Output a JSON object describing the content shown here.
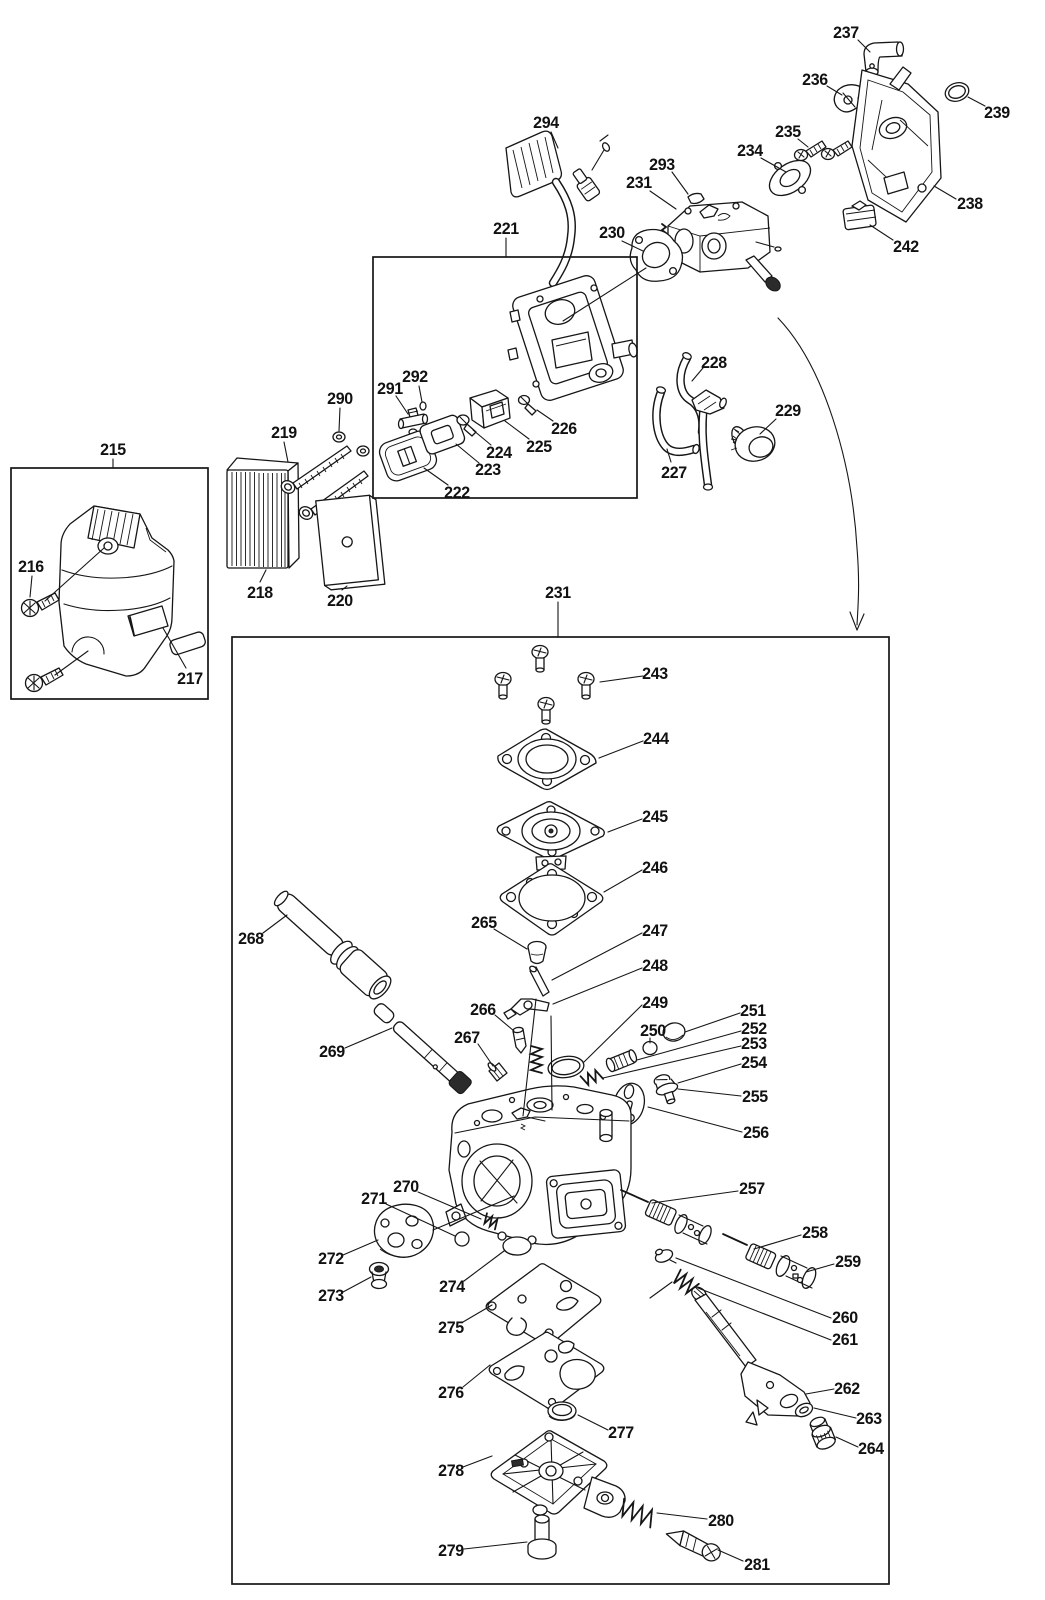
{
  "figure": {
    "background": "#ffffff",
    "ink": "#161616",
    "boxes": [
      {
        "x": 11,
        "y": 468,
        "w": 197,
        "h": 231
      },
      {
        "x": 373,
        "y": 257,
        "w": 264,
        "h": 241
      },
      {
        "x": 232,
        "y": 637,
        "w": 657,
        "h": 947
      }
    ],
    "arrow": {
      "path": "M778,318 C824,366 852,462 857,548 C860,585 858,606 857,625",
      "head": [
        [
          850,
          612,
          857,
          630
        ],
        [
          864,
          614,
          857,
          630
        ]
      ]
    },
    "extra_lines": [
      [
        45,
        601,
        104,
        548
      ],
      [
        55,
        675,
        88,
        651
      ],
      [
        646,
        268,
        563,
        321
      ],
      [
        536,
        999,
        523,
        1116
      ],
      [
        551,
        1016,
        552,
        1110
      ],
      [
        433,
        1230,
        514,
        1196
      ]
    ],
    "labels": [
      {
        "t": "215",
        "x": 113,
        "y": 449,
        "l": [
          113,
          459,
          113,
          468
        ]
      },
      {
        "t": "216",
        "x": 31,
        "y": 566,
        "l": [
          32,
          576,
          30,
          597
        ]
      },
      {
        "t": "217",
        "x": 190,
        "y": 678,
        "l": [
          186,
          668,
          163,
          628
        ]
      },
      {
        "t": "218",
        "x": 260,
        "y": 592,
        "l": [
          260,
          582,
          266,
          570
        ]
      },
      {
        "t": "219",
        "x": 284,
        "y": 432,
        "l": [
          284,
          442,
          288,
          462
        ]
      },
      {
        "t": "220",
        "x": 340,
        "y": 600,
        "l": [
          342,
          590,
          347,
          586
        ]
      },
      {
        "t": "221",
        "x": 506,
        "y": 228,
        "l": [
          506,
          238,
          506,
          257
        ]
      },
      {
        "t": "222",
        "x": 457,
        "y": 492,
        "l": [
          448,
          485,
          424,
          468
        ]
      },
      {
        "t": "223",
        "x": 488,
        "y": 469,
        "l": [
          479,
          463,
          456,
          444
        ]
      },
      {
        "t": "224",
        "x": 499,
        "y": 452,
        "l": [
          491,
          445,
          473,
          430
        ]
      },
      {
        "t": "225",
        "x": 539,
        "y": 446,
        "l": [
          529,
          439,
          505,
          421
        ]
      },
      {
        "t": "226",
        "x": 564,
        "y": 428,
        "l": [
          553,
          421,
          537,
          410
        ]
      },
      {
        "t": "227",
        "x": 674,
        "y": 472,
        "l": [
          671,
          462,
          667,
          449
        ]
      },
      {
        "t": "228",
        "x": 714,
        "y": 362,
        "l": [
          703,
          368,
          692,
          381
        ]
      },
      {
        "t": "229",
        "x": 788,
        "y": 410,
        "l": [
          776,
          419,
          760,
          434
        ]
      },
      {
        "t": "230",
        "x": 612,
        "y": 232,
        "l": [
          622,
          241,
          643,
          251
        ]
      },
      {
        "t": "231",
        "x": 639,
        "y": 182,
        "l": [
          650,
          191,
          676,
          209
        ]
      },
      {
        "t": "234",
        "x": 750,
        "y": 150,
        "l": [
          761,
          158,
          786,
          172
        ]
      },
      {
        "t": "235",
        "x": 788,
        "y": 131,
        "l": [
          798,
          139,
          808,
          147
        ]
      },
      {
        "t": "236",
        "x": 815,
        "y": 79,
        "l": [
          827,
          86,
          842,
          95
        ]
      },
      {
        "t": "237",
        "x": 846,
        "y": 32,
        "l": [
          858,
          40,
          870,
          52
        ]
      },
      {
        "t": "238",
        "x": 970,
        "y": 203,
        "l": [
          956,
          199,
          934,
          186
        ]
      },
      {
        "t": "239",
        "x": 997,
        "y": 112,
        "l": [
          985,
          106,
          968,
          97
        ]
      },
      {
        "t": "242",
        "x": 906,
        "y": 246,
        "l": [
          893,
          240,
          870,
          225
        ]
      },
      {
        "t": "231",
        "x": 558,
        "y": 592,
        "l": [
          558,
          602,
          558,
          637
        ]
      },
      {
        "t": "243",
        "x": 655,
        "y": 673,
        "l": [
          643,
          676,
          600,
          682
        ]
      },
      {
        "t": "244",
        "x": 656,
        "y": 738,
        "l": [
          643,
          741,
          599,
          758
        ]
      },
      {
        "t": "245",
        "x": 655,
        "y": 816,
        "l": [
          642,
          819,
          608,
          832
        ]
      },
      {
        "t": "246",
        "x": 655,
        "y": 867,
        "l": [
          642,
          870,
          604,
          892
        ]
      },
      {
        "t": "247",
        "x": 655,
        "y": 930,
        "l": [
          642,
          933,
          552,
          980
        ]
      },
      {
        "t": "248",
        "x": 655,
        "y": 965,
        "l": [
          642,
          968,
          553,
          1004
        ]
      },
      {
        "t": "249",
        "x": 655,
        "y": 1002,
        "l": [
          642,
          1005,
          584,
          1062
        ]
      },
      {
        "t": "250",
        "x": 653,
        "y": 1030,
        "l": [
          650,
          1038,
          650,
          1043
        ]
      },
      {
        "t": "251",
        "x": 753,
        "y": 1010,
        "l": [
          740,
          1013,
          685,
          1032
        ]
      },
      {
        "t": "252",
        "x": 754,
        "y": 1028,
        "l": [
          741,
          1031,
          637,
          1060
        ]
      },
      {
        "t": "253",
        "x": 754,
        "y": 1043,
        "l": [
          741,
          1046,
          603,
          1078
        ]
      },
      {
        "t": "254",
        "x": 754,
        "y": 1062,
        "l": [
          741,
          1064,
          678,
          1083
        ]
      },
      {
        "t": "255",
        "x": 755,
        "y": 1096,
        "l": [
          741,
          1096,
          678,
          1089
        ]
      },
      {
        "t": "256",
        "x": 756,
        "y": 1132,
        "l": [
          742,
          1132,
          648,
          1107
        ]
      },
      {
        "t": "257",
        "x": 752,
        "y": 1188,
        "l": [
          738,
          1191,
          652,
          1203
        ]
      },
      {
        "t": "258",
        "x": 815,
        "y": 1232,
        "l": [
          801,
          1235,
          754,
          1249
        ]
      },
      {
        "t": "259",
        "x": 848,
        "y": 1261,
        "l": [
          834,
          1264,
          806,
          1272
        ]
      },
      {
        "t": "260",
        "x": 845,
        "y": 1317,
        "l": [
          831,
          1318,
          676,
          1258
        ]
      },
      {
        "t": "261",
        "x": 845,
        "y": 1339,
        "l": [
          831,
          1340,
          698,
          1288
        ]
      },
      {
        "t": "262",
        "x": 847,
        "y": 1388,
        "l": [
          834,
          1389,
          806,
          1394
        ]
      },
      {
        "t": "263",
        "x": 869,
        "y": 1418,
        "l": [
          856,
          1418,
          814,
          1408
        ]
      },
      {
        "t": "264",
        "x": 871,
        "y": 1448,
        "l": [
          858,
          1447,
          836,
          1437
        ]
      },
      {
        "t": "265",
        "x": 484,
        "y": 922,
        "l": [
          494,
          929,
          527,
          949
        ]
      },
      {
        "t": "266",
        "x": 483,
        "y": 1009,
        "l": [
          495,
          1015,
          514,
          1031
        ]
      },
      {
        "t": "267",
        "x": 467,
        "y": 1037,
        "l": [
          478,
          1044,
          493,
          1066
        ]
      },
      {
        "t": "268",
        "x": 251,
        "y": 938,
        "l": [
          263,
          933,
          287,
          915
        ]
      },
      {
        "t": "269",
        "x": 332,
        "y": 1051,
        "l": [
          345,
          1048,
          392,
          1028
        ]
      },
      {
        "t": "270",
        "x": 406,
        "y": 1186,
        "l": [
          418,
          1192,
          481,
          1219
        ]
      },
      {
        "t": "271",
        "x": 374,
        "y": 1198,
        "l": [
          386,
          1204,
          455,
          1236
        ]
      },
      {
        "t": "272",
        "x": 331,
        "y": 1258,
        "l": [
          343,
          1255,
          378,
          1240
        ]
      },
      {
        "t": "273",
        "x": 331,
        "y": 1295,
        "l": [
          343,
          1292,
          371,
          1277
        ]
      },
      {
        "t": "274",
        "x": 452,
        "y": 1286,
        "l": [
          464,
          1281,
          504,
          1251
        ]
      },
      {
        "t": "275",
        "x": 451,
        "y": 1327,
        "l": [
          463,
          1322,
          492,
          1305
        ]
      },
      {
        "t": "276",
        "x": 451,
        "y": 1392,
        "l": [
          463,
          1387,
          490,
          1365
        ]
      },
      {
        "t": "277",
        "x": 621,
        "y": 1432,
        "l": [
          608,
          1430,
          578,
          1415
        ]
      },
      {
        "t": "278",
        "x": 451,
        "y": 1470,
        "l": [
          463,
          1467,
          492,
          1456
        ]
      },
      {
        "t": "279",
        "x": 451,
        "y": 1550,
        "l": [
          464,
          1549,
          527,
          1542
        ]
      },
      {
        "t": "280",
        "x": 721,
        "y": 1520,
        "l": [
          707,
          1519,
          657,
          1513
        ]
      },
      {
        "t": "281",
        "x": 757,
        "y": 1564,
        "l": [
          743,
          1561,
          718,
          1550
        ]
      },
      {
        "t": "290",
        "x": 340,
        "y": 398,
        "l": [
          340,
          408,
          339,
          431
        ]
      },
      {
        "t": "291",
        "x": 390,
        "y": 388,
        "l": [
          396,
          396,
          408,
          414
        ]
      },
      {
        "t": "292",
        "x": 415,
        "y": 376,
        "l": [
          419,
          386,
          422,
          402
        ]
      },
      {
        "t": "293",
        "x": 662,
        "y": 164,
        "l": [
          672,
          172,
          688,
          194
        ]
      },
      {
        "t": "294",
        "x": 546,
        "y": 122,
        "l": [
          551,
          132,
          558,
          148
        ]
      }
    ]
  }
}
